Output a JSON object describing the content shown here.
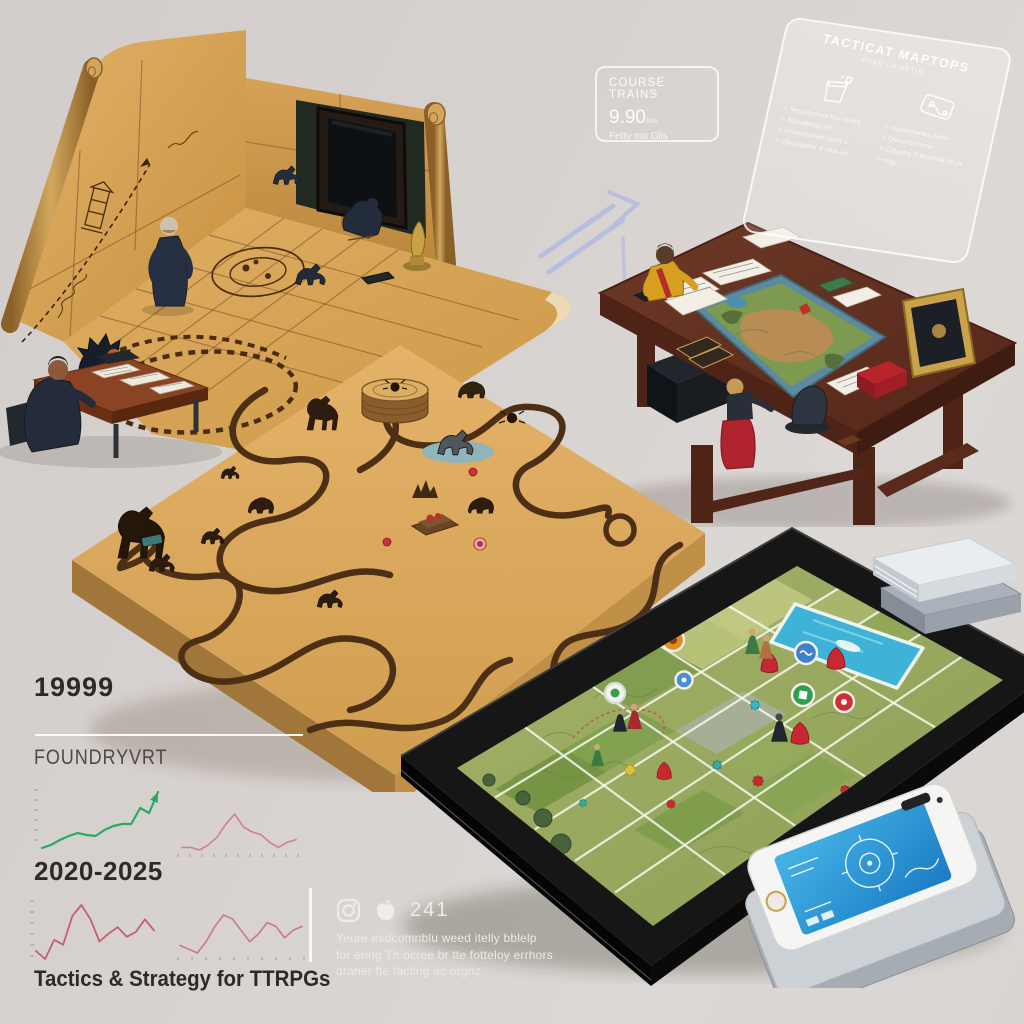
{
  "colors": {
    "background": "#d7d2cf",
    "parchment": "#d9a85e",
    "table_wood": "#5c2c1e",
    "tablet_map_green": "#9aaa62",
    "water_blue": "#45b4d8",
    "phone_screen_blue": "#2a9ad8",
    "growth_green": "#2aa964",
    "decline_pink": "#cf8191",
    "text_dark": "#2d2b2a"
  },
  "course_card": {
    "title": "COURSE TRAINS",
    "price": "9.90",
    "price_suffix": "/as",
    "subtitle": "Fetty mo Glis"
  },
  "glass_panel": {
    "title": "TACTICAT MAPTOPS",
    "subtitle": "PAVD LA ASTID",
    "columns": [
      {
        "icon": "dice-cup-icon",
        "items": [
          "Negomstsva bsv dours",
          "Bassabegy se",
          "Hbnsonvevst ovrst s",
          "Obsosbefst tf vbts ue"
        ]
      },
      {
        "icon": "map-sheet-icon",
        "items": [
          "Inasmosvtes daver",
          "Qstsszbsvseyt",
          "Cdbighq tf eosskva tol ja",
          "osgy"
        ]
      }
    ]
  },
  "stats": {
    "big_number": "19999",
    "brand": "FOUNDRYVRT",
    "period": "2020-2025",
    "title": "Tactics & Strategy for TTRPGs"
  },
  "social": {
    "icons": [
      "instagram-icon",
      "apple-icon"
    ],
    "count": "241",
    "caption_lines": [
      "Yeure esdcomnblu weed itelly bblelp",
      "for ering Th ocree br tte fotteloy errhors",
      "draher fte facting ac orgriz."
    ]
  },
  "chart_data": [
    {
      "type": "line",
      "name": "growth-trend",
      "color": "#2aa964",
      "arrow_end": true,
      "values": [
        1.8,
        2.1,
        2.6,
        3.0,
        3.3,
        3.1,
        3.0,
        3.6,
        4.0,
        4.2,
        4.2,
        5.8,
        5.3,
        7.4
      ],
      "xlabel": "",
      "ylabel": "",
      "grid": false,
      "legend": "none",
      "x_range_label": "2020-2025"
    },
    {
      "type": "line",
      "name": "flat-trend-a",
      "color": "#cf8191",
      "values": [
        2.2,
        2.2,
        2.1,
        2.3,
        2.6,
        3.1,
        3.5,
        3.0,
        2.8,
        2.7,
        2.4,
        2.2,
        2.4,
        2.5
      ]
    },
    {
      "type": "line",
      "name": "volatile-trend",
      "color": "#c4606e",
      "values": [
        2.4,
        1.9,
        3.1,
        2.8,
        4.6,
        5.3,
        4.4,
        3.0,
        3.5,
        3.9,
        3.3,
        3.6,
        4.4,
        3.7
      ]
    },
    {
      "type": "line",
      "name": "flat-trend-b",
      "color": "#c97986",
      "values": [
        1.8,
        1.7,
        1.6,
        1.9,
        2.3,
        2.6,
        2.5,
        2.2,
        1.9,
        2.1,
        2.4,
        2.3,
        2.0,
        2.2,
        2.3
      ]
    }
  ]
}
